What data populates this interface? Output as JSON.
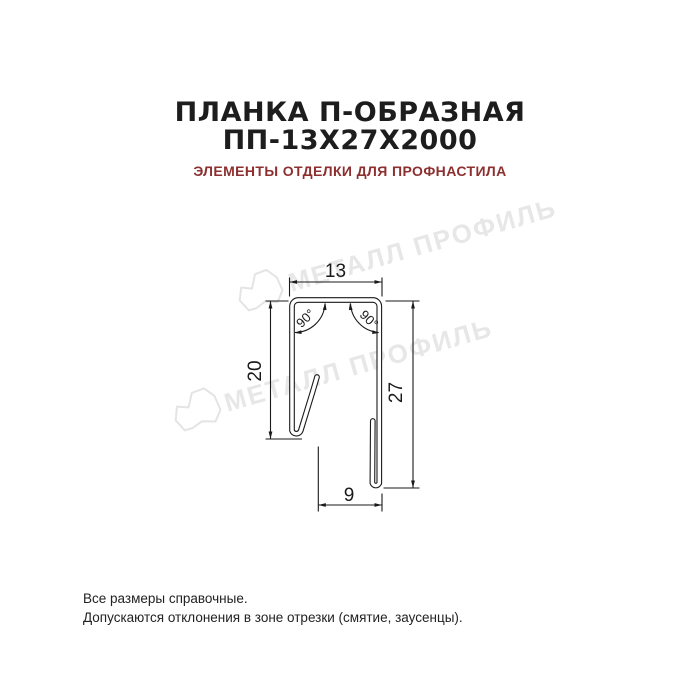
{
  "title": {
    "line1": "ПЛАНКА П-ОБРАЗНАЯ",
    "line2": "ПП-13Х27Х2000"
  },
  "subtitle": "ЭЛЕМЕНТЫ ОТДЕЛКИ ДЛЯ ПРОФНАСТИЛА",
  "watermark": {
    "text": "МЕТАЛЛ ПРОФИЛЬ"
  },
  "drawing": {
    "dim_top_width": "13",
    "dim_left_height": "20",
    "dim_right_height": "27",
    "dim_bottom_width": "9",
    "angle_left": "90°",
    "angle_right": "90°"
  },
  "footer": {
    "line1": "Все размеры справочные.",
    "line2": "Допускаются отклонения в зоне отрезки (смятие, заусенцы)."
  },
  "colors": {
    "text": "#1d1d1d",
    "subtitle_red": "#8d2f2f",
    "line": "#1a1a1a",
    "watermark": "#e7e7e7",
    "watermark_stroke": "#e4e4e4"
  }
}
